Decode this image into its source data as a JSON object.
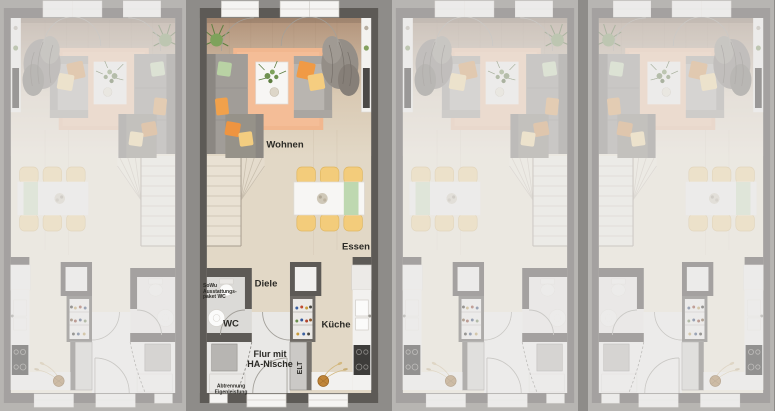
{
  "page": {
    "type": "townhouse-floorplan-row",
    "description_visible": "Four identical ground-floor townhouse plans side by side, second unit highlighted with room labels"
  },
  "units": {
    "count": 4,
    "highlighted_panel": 2,
    "mirrored_panels": [
      1,
      3
    ]
  },
  "labels": {
    "wohnen": "Wohnen",
    "essen": "Essen",
    "diele": "Diele",
    "wc": "WC",
    "kueche": "Küche",
    "flur": "Flur mit\nHA-Nische",
    "elt": "ELT",
    "sowu": "SoWu\nAusstattungs-\npaket WC",
    "abtrennung": "Abtrennung\nEigenleistung"
  },
  "colors": {
    "background": "#8e8c89",
    "wall": "#5d5a56",
    "floor_wood": "#e2d8c6",
    "floor_light": "#e9e8e6",
    "rug": "#f1b78f",
    "accent_orange": "#ee9440",
    "accent_yellow": "#f3cd80",
    "accent_green": "#b9d2a4",
    "chair_yellow": "#f3cc7b",
    "label_text": "#2b2a26"
  }
}
